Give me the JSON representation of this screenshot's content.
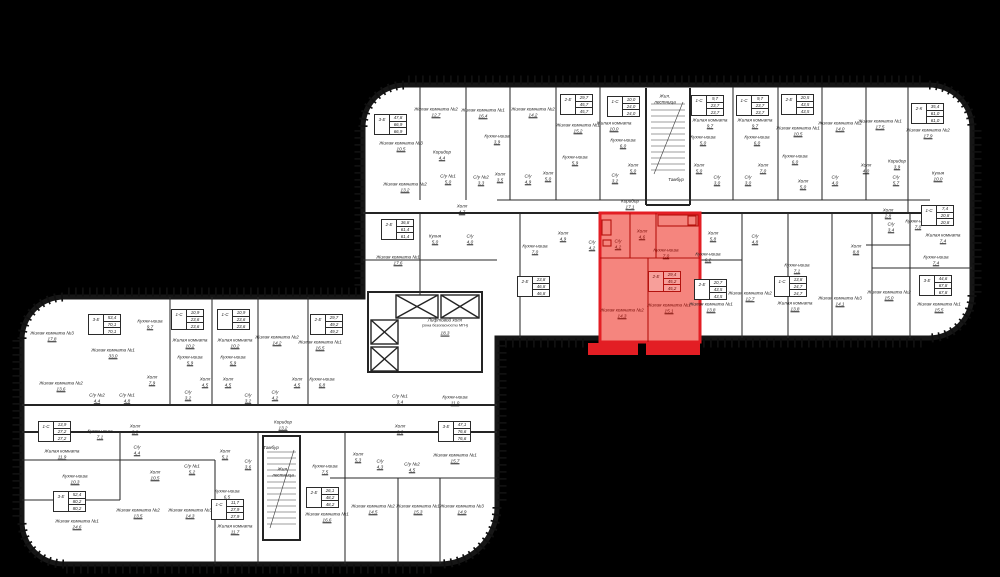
{
  "plan": {
    "title": "Поэтажный план",
    "highlight": {
      "unit_type": "2-Е",
      "areas": [
        "29,4",
        "45,2",
        "45,2"
      ],
      "color_fill": "#f5857e",
      "color_stroke": "#e31e24"
    },
    "colors": {
      "background": "#000000",
      "floor": "#ffffff",
      "walls": "#161616",
      "highlight": "#e31e24"
    },
    "elevator_hall": {
      "line1": "Лифтовой холл",
      "line2": "(зона безопасности МГН)",
      "area": "18,3"
    }
  },
  "units": [
    {
      "type": "3-Е",
      "v": [
        "47,8",
        "66,9",
        "66,9"
      ],
      "x": 374,
      "y": 114
    },
    {
      "type": "2-Е",
      "v": [
        "29,7",
        "45,7",
        "45,7"
      ],
      "x": 560,
      "y": 94
    },
    {
      "type": "1-С",
      "v": [
        "10,0",
        "24,0",
        "24,0"
      ],
      "x": 607,
      "y": 96
    },
    {
      "type": "1-С",
      "v": [
        "9,7",
        "23,7",
        "23,7"
      ],
      "x": 691,
      "y": 95
    },
    {
      "type": "1-С",
      "v": [
        "9,7",
        "23,7",
        "23,7"
      ],
      "x": 736,
      "y": 95
    },
    {
      "type": "2-Е",
      "v": [
        "20,5",
        "43,5",
        "43,5"
      ],
      "x": 781,
      "y": 94
    },
    {
      "type": "2-К",
      "v": [
        "35,4",
        "61,0",
        "61,0"
      ],
      "x": 911,
      "y": 103
    },
    {
      "type": "1-С",
      "v": [
        "7,4",
        "20,8",
        "20,8"
      ],
      "x": 921,
      "y": 205
    },
    {
      "type": "3-Е",
      "v": [
        "44,6",
        "67,8",
        "67,8"
      ],
      "x": 919,
      "y": 275
    },
    {
      "type": "2-Е",
      "v": [
        "36,8",
        "61,4",
        "61,4"
      ],
      "x": 381,
      "y": 219
    },
    {
      "type": "2-Е",
      "v": [
        "23,8",
        "46,8",
        "46,8"
      ],
      "x": 517,
      "y": 276
    },
    {
      "type": "2-Е",
      "v": [
        "29,4",
        "45,2",
        "45,2"
      ],
      "x": 648,
      "y": 271,
      "red": true
    },
    {
      "type": "2-Е",
      "v": [
        "20,7",
        "43,5",
        "43,5"
      ],
      "x": 694,
      "y": 279
    },
    {
      "type": "1-С",
      "v": [
        "13,8",
        "24,7",
        "24,7"
      ],
      "x": 774,
      "y": 276
    },
    {
      "type": "3-Е",
      "v": [
        "53,4",
        "70,1",
        "70,1"
      ],
      "x": 88,
      "y": 314
    },
    {
      "type": "1-С",
      "v": [
        "10,9",
        "23,6",
        "23,6"
      ],
      "x": 171,
      "y": 309
    },
    {
      "type": "1-С",
      "v": [
        "10,9",
        "23,6",
        "23,6"
      ],
      "x": 217,
      "y": 309
    },
    {
      "type": "2-Е",
      "v": [
        "29,7",
        "49,2",
        "49,2"
      ],
      "x": 310,
      "y": 314
    },
    {
      "type": "1-С",
      "v": [
        "13,9",
        "27,2",
        "27,2"
      ],
      "x": 38,
      "y": 421
    },
    {
      "type": "3-Е",
      "v": [
        "52,4",
        "80,2",
        "80,2"
      ],
      "x": 53,
      "y": 491
    },
    {
      "type": "1-С",
      "v": [
        "11,7",
        "27,9",
        "27,9"
      ],
      "x": 211,
      "y": 499
    },
    {
      "type": "2-Е",
      "v": [
        "26,1",
        "48,2",
        "48,2"
      ],
      "x": 306,
      "y": 487
    },
    {
      "type": "3-Е",
      "v": [
        "47,1",
        "76,6",
        "76,6"
      ],
      "x": 438,
      "y": 421
    }
  ],
  "rooms": [
    {
      "t": "Жилая комната №3",
      "a": "10,5",
      "x": 401,
      "y": 146
    },
    {
      "t": "Жилая комната №2",
      "a": "12,7",
      "x": 436,
      "y": 112
    },
    {
      "t": "Жилая комната №1",
      "a": "16,4",
      "x": 483,
      "y": 113
    },
    {
      "t": "Кухня-ниша",
      "a": "3,9",
      "x": 497,
      "y": 139
    },
    {
      "t": "Жилая комната №2",
      "a": "14,2",
      "x": 533,
      "y": 112
    },
    {
      "t": "Холл",
      "a": "3,5",
      "x": 500,
      "y": 177
    },
    {
      "t": "С/у",
      "a": "4,9",
      "x": 528,
      "y": 179
    },
    {
      "t": "Холл",
      "a": "5,0",
      "x": 548,
      "y": 176
    },
    {
      "t": "Жилая комната №1",
      "a": "15,2",
      "x": 578,
      "y": 128
    },
    {
      "t": "Кухня-ниша",
      "a": "5,9",
      "x": 575,
      "y": 160
    },
    {
      "t": "Жилая комната",
      "a": "10,0",
      "x": 614,
      "y": 126
    },
    {
      "t": "Кухня-ниша",
      "a": "6,0",
      "x": 623,
      "y": 143
    },
    {
      "t": "Холл",
      "a": "5,0",
      "x": 633,
      "y": 168
    },
    {
      "t": "С/у",
      "a": "3,2",
      "x": 615,
      "y": 178
    },
    {
      "t": "Жил.",
      "t2": "лестница",
      "a": "",
      "x": 665,
      "y": 99
    },
    {
      "t": "Тамбур",
      "a": "",
      "x": 676,
      "y": 180
    },
    {
      "t": "Жилая комната",
      "a": "9,7",
      "x": 710,
      "y": 123
    },
    {
      "t": "Кухня-ниша",
      "a": "5,0",
      "x": 703,
      "y": 140
    },
    {
      "t": "Холл",
      "a": "5,0",
      "x": 699,
      "y": 168
    },
    {
      "t": "С/у",
      "a": "3,0",
      "x": 717,
      "y": 180
    },
    {
      "t": "Жилая комната",
      "a": "9,7",
      "x": 755,
      "y": 123
    },
    {
      "t": "Кухня-ниша",
      "a": "6,0",
      "x": 757,
      "y": 140
    },
    {
      "t": "Холл",
      "a": "7,0",
      "x": 763,
      "y": 168
    },
    {
      "t": "С/у",
      "a": "3,0",
      "x": 748,
      "y": 180
    },
    {
      "t": "Жилая комната №1",
      "a": "10,5",
      "x": 798,
      "y": 131
    },
    {
      "t": "Кухня-ниша",
      "a": "6,0",
      "x": 795,
      "y": 159
    },
    {
      "t": "Холл",
      "a": "5,0",
      "x": 803,
      "y": 184
    },
    {
      "t": "Жилая комната №2",
      "a": "14,0",
      "x": 840,
      "y": 126
    },
    {
      "t": "С/у",
      "a": "4,0",
      "x": 835,
      "y": 180
    },
    {
      "t": "Жилая комната №1",
      "a": "17,5",
      "x": 880,
      "y": 124
    },
    {
      "t": "Жилая комната №2",
      "a": "17,9",
      "x": 928,
      "y": 133
    },
    {
      "t": "Коридор",
      "a": "3,9",
      "x": 897,
      "y": 164
    },
    {
      "t": "Холл",
      "a": "4,0",
      "x": 866,
      "y": 168
    },
    {
      "t": "С/у",
      "a": "5,7",
      "x": 896,
      "y": 180
    },
    {
      "t": "Кухня",
      "a": "10,0",
      "x": 938,
      "y": 176
    },
    {
      "t": "Холл",
      "a": "2,8",
      "x": 888,
      "y": 213
    },
    {
      "t": "С/у",
      "a": "3,4",
      "x": 891,
      "y": 227
    },
    {
      "t": "Кухня-ниша",
      "a": "7,0",
      "x": 918,
      "y": 224
    },
    {
      "t": "Жилая комната",
      "a": "7,4",
      "x": 943,
      "y": 238
    },
    {
      "t": "Холл",
      "a": "8,8",
      "x": 856,
      "y": 249
    },
    {
      "t": "Кухня-ниша",
      "a": "7,4",
      "x": 936,
      "y": 260
    },
    {
      "t": "Жилая комната №2",
      "a": "15,0",
      "x": 889,
      "y": 295
    },
    {
      "t": "Жилая комната №1",
      "a": "15,5",
      "x": 939,
      "y": 307
    },
    {
      "t": "Коридор",
      "a": "4,4",
      "x": 442,
      "y": 155
    },
    {
      "t": "С/у №1",
      "a": "5,0",
      "x": 448,
      "y": 179
    },
    {
      "t": "С/у №2",
      "a": "3,3",
      "x": 481,
      "y": 180
    },
    {
      "t": "Жилая комната №2",
      "a": "13,2",
      "x": 405,
      "y": 187
    },
    {
      "t": "Холл",
      "a": "4,7",
      "x": 462,
      "y": 209
    },
    {
      "t": "Кухня",
      "a": "5,0",
      "x": 435,
      "y": 239
    },
    {
      "t": "С/у",
      "a": "4,0",
      "x": 470,
      "y": 239
    },
    {
      "t": "Жилая комната №1",
      "a": "17,6",
      "x": 398,
      "y": 260
    },
    {
      "t": "Коридор",
      "a": "17,1",
      "x": 630,
      "y": 204
    },
    {
      "t": "Кухня-ниша",
      "a": "7,0",
      "x": 535,
      "y": 249
    },
    {
      "t": "Холл",
      "a": "4,9",
      "x": 563,
      "y": 236
    },
    {
      "t": "С/у",
      "a": "4,2",
      "x": 592,
      "y": 245
    },
    {
      "t": "С/у",
      "a": "4,2",
      "x": 618,
      "y": 244,
      "red": true
    },
    {
      "t": "Холл",
      "a": "4,6",
      "x": 642,
      "y": 234,
      "red": true
    },
    {
      "t": "Кухня-ниша",
      "a": "7,0",
      "x": 666,
      "y": 253,
      "red": true
    },
    {
      "t": "Жилая комната №2",
      "a": "14,3",
      "x": 622,
      "y": 313,
      "red": true
    },
    {
      "t": "Жилая комната №1",
      "a": "15,1",
      "x": 669,
      "y": 308,
      "red": true
    },
    {
      "t": "Холл",
      "a": "5,8",
      "x": 713,
      "y": 236
    },
    {
      "t": "Кухня-ниша",
      "a": "6,2",
      "x": 708,
      "y": 257
    },
    {
      "t": "С/у",
      "a": "4,8",
      "x": 755,
      "y": 239
    },
    {
      "t": "Жилая комната №1",
      "a": "13,8",
      "x": 711,
      "y": 307
    },
    {
      "t": "Жилая комната №2",
      "a": "12,7",
      "x": 750,
      "y": 296
    },
    {
      "t": "Кухня-ниша",
      "a": "7,1",
      "x": 797,
      "y": 268
    },
    {
      "t": "Жилая комната",
      "a": "13,8",
      "x": 795,
      "y": 306
    },
    {
      "t": "Жилая комната №3",
      "a": "14,1",
      "x": 840,
      "y": 301
    },
    {
      "t": "Жилая комната №3",
      "a": "17,8",
      "x": 52,
      "y": 336
    },
    {
      "t": "Жилая комната №1",
      "a": "33,0",
      "x": 113,
      "y": 353
    },
    {
      "t": "Жилая комната №2",
      "a": "13,6",
      "x": 61,
      "y": 386
    },
    {
      "t": "С/у №2",
      "a": "4,4",
      "x": 97,
      "y": 398
    },
    {
      "t": "С/у №1",
      "a": "4,8",
      "x": 127,
      "y": 398
    },
    {
      "t": "Кухня-ниша",
      "a": "9,7",
      "x": 150,
      "y": 324
    },
    {
      "t": "Холл",
      "a": "7,9",
      "x": 152,
      "y": 380
    },
    {
      "t": "Жилая комната",
      "a": "10,2",
      "x": 190,
      "y": 343
    },
    {
      "t": "Кухня-ниша",
      "a": "5,9",
      "x": 190,
      "y": 360
    },
    {
      "t": "Холл",
      "a": "4,5",
      "x": 205,
      "y": 382
    },
    {
      "t": "С/у",
      "a": "3,2",
      "x": 188,
      "y": 395
    },
    {
      "t": "Жилая комната",
      "a": "10,2",
      "x": 235,
      "y": 343
    },
    {
      "t": "Кухня-ниша",
      "a": "5,9",
      "x": 233,
      "y": 360
    },
    {
      "t": "Холл",
      "a": "4,5",
      "x": 228,
      "y": 382
    },
    {
      "t": "С/у",
      "a": "3,2",
      "x": 248,
      "y": 398
    },
    {
      "t": "Жилая комната №2",
      "a": "14,2",
      "x": 277,
      "y": 340
    },
    {
      "t": "С/у",
      "a": "4,2",
      "x": 275,
      "y": 395
    },
    {
      "t": "Холл",
      "a": "4,5",
      "x": 297,
      "y": 382
    },
    {
      "t": "Жилая комната №1",
      "a": "16,5",
      "x": 320,
      "y": 345
    },
    {
      "t": "Кухня-ниша",
      "a": "6,8",
      "x": 322,
      "y": 382
    },
    {
      "t": "Коридор",
      "a": "13,2",
      "x": 283,
      "y": 425
    },
    {
      "t": "Жилая комната",
      "a": "11,9",
      "x": 62,
      "y": 454
    },
    {
      "t": "Кухня-ниша",
      "a": "7,1",
      "x": 100,
      "y": 434
    },
    {
      "t": "Холл",
      "a": "3,8",
      "x": 135,
      "y": 429
    },
    {
      "t": "С/у",
      "a": "4,4",
      "x": 137,
      "y": 450
    },
    {
      "t": "Кухня-ниша",
      "a": "10,3",
      "x": 75,
      "y": 479
    },
    {
      "t": "Жилая комната №1",
      "a": "24,6",
      "x": 77,
      "y": 524
    },
    {
      "t": "Жилая комната №2",
      "a": "13,5",
      "x": 138,
      "y": 513
    },
    {
      "t": "Жилая комната №3",
      "a": "14,3",
      "x": 190,
      "y": 513
    },
    {
      "t": "Холл",
      "a": "10,5",
      "x": 155,
      "y": 475
    },
    {
      "t": "С/у №1",
      "a": "5,2",
      "x": 192,
      "y": 469
    },
    {
      "t": "Холл",
      "a": "5,1",
      "x": 225,
      "y": 454
    },
    {
      "t": "С/у",
      "a": "3,6",
      "x": 248,
      "y": 464
    },
    {
      "t": "Кухня-ниша",
      "a": "6,5",
      "x": 227,
      "y": 494
    },
    {
      "t": "Жилая комната",
      "a": "11,7",
      "x": 235,
      "y": 529
    },
    {
      "t": "Тамбур",
      "a": "",
      "x": 271,
      "y": 448
    },
    {
      "t": "Жил.",
      "t2": "лестница",
      "a": "",
      "x": 283,
      "y": 472
    },
    {
      "t": "Кухня-ниша",
      "a": "7,5",
      "x": 325,
      "y": 469
    },
    {
      "t": "Жилая комната №1",
      "a": "16,6",
      "x": 327,
      "y": 517
    },
    {
      "t": "Холл",
      "a": "6,6",
      "x": 400,
      "y": 429
    },
    {
      "t": "Холл",
      "a": "5,3",
      "x": 358,
      "y": 457
    },
    {
      "t": "С/у",
      "a": "4,3",
      "x": 380,
      "y": 464
    },
    {
      "t": "С/у №2",
      "a": "4,5",
      "x": 412,
      "y": 467
    },
    {
      "t": "Жилая комната №1",
      "a": "15,7",
      "x": 455,
      "y": 458
    },
    {
      "t": "Жилая комната №2",
      "a": "14,5",
      "x": 373,
      "y": 509
    },
    {
      "t": "Жилая комната №1",
      "a": "15,3",
      "x": 418,
      "y": 509
    },
    {
      "t": "Жилая комната №3",
      "a": "14,9",
      "x": 462,
      "y": 509
    },
    {
      "t": "С/у №1",
      "a": "3,4",
      "x": 400,
      "y": 399
    },
    {
      "t": "Кухня-ниша",
      "a": "11,0",
      "x": 455,
      "y": 400
    }
  ]
}
